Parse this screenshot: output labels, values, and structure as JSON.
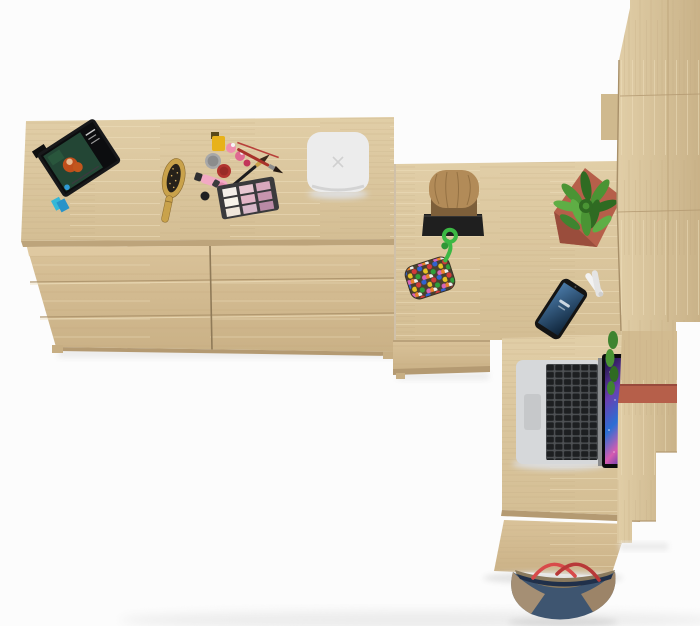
{
  "meta": {
    "title": "Top-view 3D render of a Sonoma oak furniture set",
    "description": "Overhead product render: wide oak dresser topped with a tablet, hairbrush, cosmetics and a white speaker; an L-shaped oak desk with log stool, potted succulent, beaded pouch, smartphone and open laptop; tall oak wardrobe column on the right; denim tote bag at the bottom edge."
  },
  "colors": {
    "background": "#fcfcfc",
    "shadow": "#e8e8e8",
    "wood_light": "#e1cea7",
    "wood_mid": "#d4be94",
    "wood_deep": "#c9b288",
    "wood_front": "#d9c299",
    "wood_front_deep": "#cab186",
    "wood_edge": "#b49a72",
    "seam": "#a8906a",
    "speaker_body": "#ececec",
    "speaker_mark": "#d0d0d0",
    "stool_top": "#b28b58",
    "stool_side": "#7d5f3a",
    "stool_base": "#1f1f1f",
    "plant_green": "#4a9434",
    "plant_green_dark": "#2f6b22",
    "plant_green_light": "#5fae45",
    "pot_terracotta": "#b65f4a",
    "pot_terracotta_dark": "#9a4d3c",
    "rope_green": "#3cb844",
    "phone_body": "#141414",
    "phone_screen_light": "#4a7aa8",
    "phone_screen_dark": "#0e2338",
    "laptop_silver": "#d6d8da",
    "laptop_key_base": "#4e5154",
    "laptop_key": "#1d1f21",
    "laptop_trackpad": "#c6c8ca",
    "screen_deep": "#1b1040",
    "screen_purple": "#6a3fb0",
    "screen_blue": "#2a6fd4",
    "screen_pink": "#d65bb0",
    "bag_navy": "#3e5570",
    "bag_tan": "#ab9274",
    "bag_red": "#d84a4a",
    "brush_wood": "#c9a24b",
    "brush_bristles": "#26211a",
    "palette_case": "#3a3a3c",
    "polish_yellow": "#e8b21a",
    "jar_silver": "#a8a8a8",
    "jar_red": "#b23530",
    "tube_pink": "#f2a9c4",
    "tube_pink_deep": "#e087a8",
    "tablet_body": "#17181a",
    "movie_green": "#234635",
    "movie_hair": "#bf4e1b",
    "flag_cyan": "#35b8d8"
  },
  "objects": {
    "dresser": {
      "label": "wide oak dresser with two columns of drawers"
    },
    "desk_return": {
      "label": "oak corner desk return surface"
    },
    "under_cabinet": {
      "label": "under-desk drawer cabinet"
    },
    "desk": {
      "label": "oak desk surface"
    },
    "side_panel": {
      "label": "desk front side panel"
    },
    "wardrobe": {
      "label": "tall oak wardrobe column with stepped panels"
    },
    "tablet": {
      "label": "tablet propped on dresser playing a movie"
    },
    "page_flags": {
      "label": "cyan sticky page flags"
    },
    "hairbrush": {
      "label": "wooden hairbrush"
    },
    "cosmetics": {
      "label": "nail polish, cream jars, lipstick tubes and makeup brushes"
    },
    "palette": {
      "label": "eyeshadow palette",
      "pans": [
        "#f3eee8",
        "#e9c7d2",
        "#d8a8bd",
        "#f7f3ea",
        "#e3b5c6",
        "#c795ad",
        "#efe6da",
        "#d8b8c8",
        "#b98aa6"
      ]
    },
    "speaker": {
      "label": "white smart speaker with x mark"
    },
    "stool": {
      "label": "log stool on black base plate"
    },
    "plant": {
      "label": "spiky succulent in terracotta pot"
    },
    "pouch": {
      "label": "multicolour beaded pouch with green rope loop"
    },
    "scissors": {
      "label": "white scissors tucked behind panel"
    },
    "phone": {
      "label": "smartphone with blue lock screen"
    },
    "laptop": {
      "label": "open laptop with galaxy wallpaper"
    },
    "bag": {
      "label": "denim tote bag with red straps"
    }
  }
}
